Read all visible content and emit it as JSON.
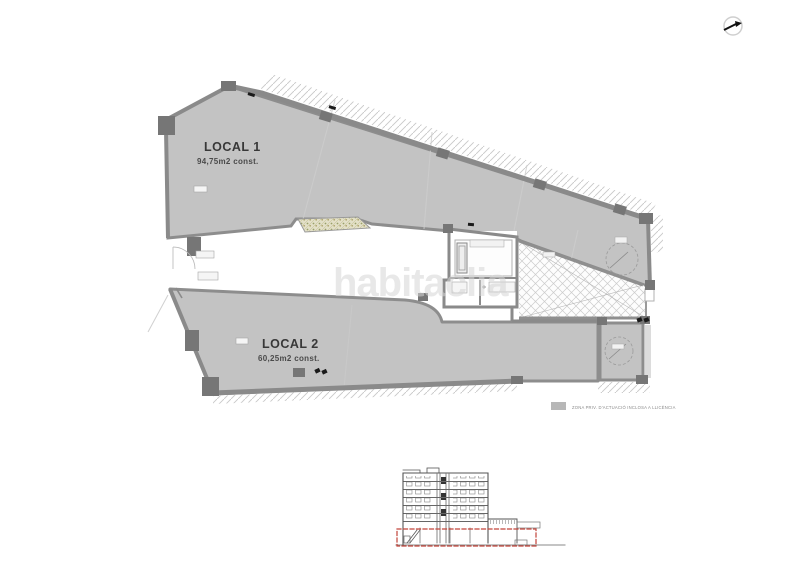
{
  "page": {
    "background_color": "#ffffff"
  },
  "floor_plan": {
    "local1": {
      "title": "LOCAL 1",
      "area": "94,75m2 const."
    },
    "local2": {
      "title": "LOCAL 2",
      "area": "60,25m2 const."
    },
    "watermark_text": "habitaclia"
  },
  "legend": {
    "label": "ZONA PRIV. D'ACTUACIÓ INCLOSA A LLICÈNCIA",
    "swatch_color": "#b7b7b7"
  },
  "colors": {
    "floor_fill": "#c3c3c3",
    "wall": "#8d8d8d",
    "pillar": "#767676",
    "red_highlight": "#c2443a",
    "watermark": "#d6d6d6"
  },
  "icons": [
    {
      "name": "north-arrow-icon"
    }
  ]
}
